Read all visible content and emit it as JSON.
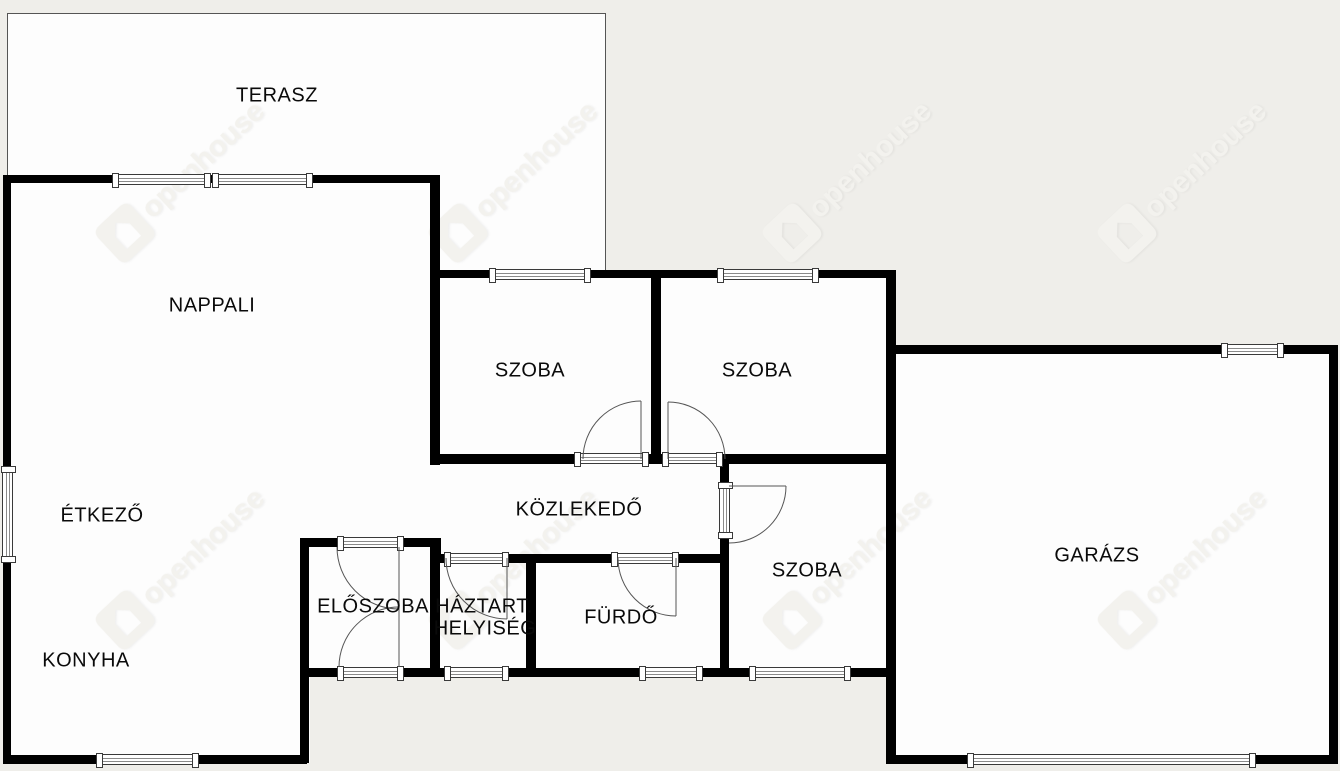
{
  "canvas": {
    "width": 1340,
    "height": 771
  },
  "colors": {
    "background": "#efeeea",
    "room_fill": "#fdfdfd",
    "wall": "#000000",
    "thin_line": "#555555",
    "window_border": "#3a3a3a",
    "label_text": "#0a0a0a",
    "watermark": "#f3f2ee"
  },
  "watermark": {
    "text": "openhouse",
    "rotation_deg": -43,
    "instances": [
      {
        "x": 102,
        "y": 210
      },
      {
        "x": 435,
        "y": 210
      },
      {
        "x": 769,
        "y": 210
      },
      {
        "x": 1104,
        "y": 210
      },
      {
        "x": 102,
        "y": 597
      },
      {
        "x": 435,
        "y": 597
      },
      {
        "x": 769,
        "y": 597
      },
      {
        "x": 1104,
        "y": 597
      }
    ]
  },
  "rooms": [
    {
      "id": "terasz",
      "label": "TERASZ",
      "cx": 277,
      "cy": 96
    },
    {
      "id": "nappali",
      "label": "NAPPALI",
      "cx": 212,
      "cy": 306
    },
    {
      "id": "etkezo",
      "label": "ÉTKEZŐ",
      "cx": 102,
      "cy": 516
    },
    {
      "id": "konyha",
      "label": "KONYHA",
      "cx": 86,
      "cy": 661
    },
    {
      "id": "szoba-1",
      "label": "SZOBA",
      "cx": 530,
      "cy": 371
    },
    {
      "id": "szoba-2",
      "label": "SZOBA",
      "cx": 757,
      "cy": 371
    },
    {
      "id": "kozlekedo",
      "label": "KÖZLEKEDŐ",
      "cx": 579,
      "cy": 510
    },
    {
      "id": "eloszoba",
      "label": "ELŐSZOBA",
      "cx": 373,
      "cy": 607
    },
    {
      "id": "haztart-line1",
      "label": "HÁZTART.",
      "cx": 484,
      "cy": 607
    },
    {
      "id": "haztart-line2",
      "label": "HELYISÉG",
      "cx": 485,
      "cy": 629
    },
    {
      "id": "furdo",
      "label": "FÜRDŐ",
      "cx": 621,
      "cy": 618
    },
    {
      "id": "szoba-3",
      "label": "SZOBA",
      "cx": 807,
      "cy": 571
    },
    {
      "id": "garazs",
      "label": "GARÁZS",
      "cx": 1097,
      "cy": 556
    }
  ],
  "plan": {
    "terrace": {
      "x": 7,
      "y": 13,
      "w": 599,
      "h": 260
    },
    "interiors": [
      {
        "x": 3,
        "y": 175,
        "w": 307,
        "h": 588
      },
      {
        "x": 300,
        "y": 175,
        "w": 140,
        "h": 501
      },
      {
        "x": 432,
        "y": 273,
        "w": 464,
        "h": 403
      },
      {
        "x": 886,
        "y": 345,
        "w": 452,
        "h": 418
      }
    ],
    "walls": [
      [
        3,
        175,
        437,
        8
      ],
      [
        3,
        175,
        8,
        588
      ],
      [
        430,
        175,
        10,
        290
      ],
      [
        430,
        270,
        466,
        8
      ],
      [
        651,
        278,
        10,
        177
      ],
      [
        886,
        270,
        10,
        493
      ],
      [
        430,
        454,
        145,
        10
      ],
      [
        648,
        454,
        15,
        10
      ],
      [
        722,
        454,
        174,
        10
      ],
      [
        720,
        464,
        9,
        19
      ],
      [
        720,
        538,
        9,
        138
      ],
      [
        430,
        554,
        15,
        9
      ],
      [
        508,
        554,
        104,
        9
      ],
      [
        678,
        554,
        51,
        9
      ],
      [
        300,
        538,
        38,
        9
      ],
      [
        403,
        538,
        37,
        9
      ],
      [
        430,
        538,
        11,
        25
      ],
      [
        300,
        538,
        9,
        225
      ],
      [
        430,
        546,
        10,
        130
      ],
      [
        526,
        556,
        10,
        120
      ],
      [
        300,
        668,
        38,
        9
      ],
      [
        403,
        668,
        42,
        9
      ],
      [
        508,
        668,
        132,
        9
      ],
      [
        702,
        668,
        48,
        9
      ],
      [
        850,
        668,
        46,
        9
      ],
      [
        3,
        755,
        94,
        9
      ],
      [
        198,
        755,
        109,
        9
      ],
      [
        886,
        345,
        336,
        9
      ],
      [
        1283,
        345,
        54,
        9
      ],
      [
        1329,
        345,
        9,
        419
      ],
      [
        886,
        755,
        82,
        9
      ],
      [
        1255,
        755,
        82,
        9
      ]
    ],
    "openings": [
      {
        "name": "window-nappali-terasz-a",
        "x": 113,
        "y": 174,
        "w": 97,
        "h": 11,
        "v": false
      },
      {
        "name": "window-nappali-terasz-b",
        "x": 213,
        "y": 174,
        "w": 99,
        "h": 11,
        "v": false
      },
      {
        "name": "window-szoba1-terasz",
        "x": 490,
        "y": 269,
        "w": 100,
        "h": 11,
        "v": false
      },
      {
        "name": "window-szoba2-top",
        "x": 718,
        "y": 269,
        "w": 100,
        "h": 11,
        "v": false
      },
      {
        "name": "window-etkezo-left",
        "x": 2,
        "y": 467,
        "w": 11,
        "h": 95,
        "v": true
      },
      {
        "name": "window-konyha-bottom",
        "x": 97,
        "y": 754,
        "w": 101,
        "h": 11,
        "v": false
      },
      {
        "name": "window-haztart-bottom",
        "x": 445,
        "y": 667,
        "w": 63,
        "h": 11,
        "v": false
      },
      {
        "name": "window-furdo-bottom",
        "x": 640,
        "y": 667,
        "w": 62,
        "h": 11,
        "v": false
      },
      {
        "name": "window-szoba3-bottom",
        "x": 750,
        "y": 667,
        "w": 100,
        "h": 11,
        "v": false
      },
      {
        "name": "window-garazs-top",
        "x": 1222,
        "y": 344,
        "w": 61,
        "h": 11,
        "v": false
      },
      {
        "name": "garage-door-sill",
        "x": 968,
        "y": 754,
        "w": 287,
        "h": 11,
        "v": false
      },
      {
        "name": "door-sill-szoba1",
        "x": 575,
        "y": 453,
        "w": 73,
        "h": 11,
        "v": false
      },
      {
        "name": "door-sill-szoba2",
        "x": 663,
        "y": 453,
        "w": 59,
        "h": 11,
        "v": false
      },
      {
        "name": "door-sill-eloszoba-top",
        "x": 338,
        "y": 537,
        "w": 65,
        "h": 11,
        "v": false
      },
      {
        "name": "door-sill-eloszoba-entry",
        "x": 338,
        "y": 667,
        "w": 65,
        "h": 11,
        "v": false
      },
      {
        "name": "door-sill-haztart",
        "x": 445,
        "y": 553,
        "w": 63,
        "h": 11,
        "v": false
      },
      {
        "name": "door-sill-furdo",
        "x": 612,
        "y": 553,
        "w": 66,
        "h": 11,
        "v": false
      },
      {
        "name": "door-sill-szoba3",
        "x": 719,
        "y": 483,
        "w": 11,
        "h": 55,
        "v": true
      }
    ],
    "door_lines": [
      {
        "name": "door-szoba1",
        "paths": [
          "M 641 459 L 641 401",
          "M 583 459 A 58 58 0 0 1 641 401"
        ]
      },
      {
        "name": "door-szoba2",
        "paths": [
          "M 668 459 L 668 402",
          "M 668 402 A 57 57 0 0 1 725 459"
        ]
      },
      {
        "name": "door-eloszoba-top",
        "paths": [
          "M 399 547 L 399 609",
          "M 337 547 A 62 62 0 0 0 399 609"
        ]
      },
      {
        "name": "door-eloszoba-entry",
        "paths": [
          "M 399 667 L 399 607",
          "M 339 667 A 60 60 0 0 1 399 607"
        ]
      },
      {
        "name": "door-haztart",
        "paths": [
          "M 507 558 L 507 619",
          "M 446 558 A 61 61 0 0 0 507 619"
        ]
      },
      {
        "name": "door-furdo",
        "paths": [
          "M 676 558 L 676 616",
          "M 618 558 A 58 58 0 0 0 676 616"
        ]
      },
      {
        "name": "door-szoba3",
        "paths": [
          "M 729 486 L 786 486",
          "M 786 486 A 57 57 0 0 1 729 543"
        ]
      }
    ]
  }
}
